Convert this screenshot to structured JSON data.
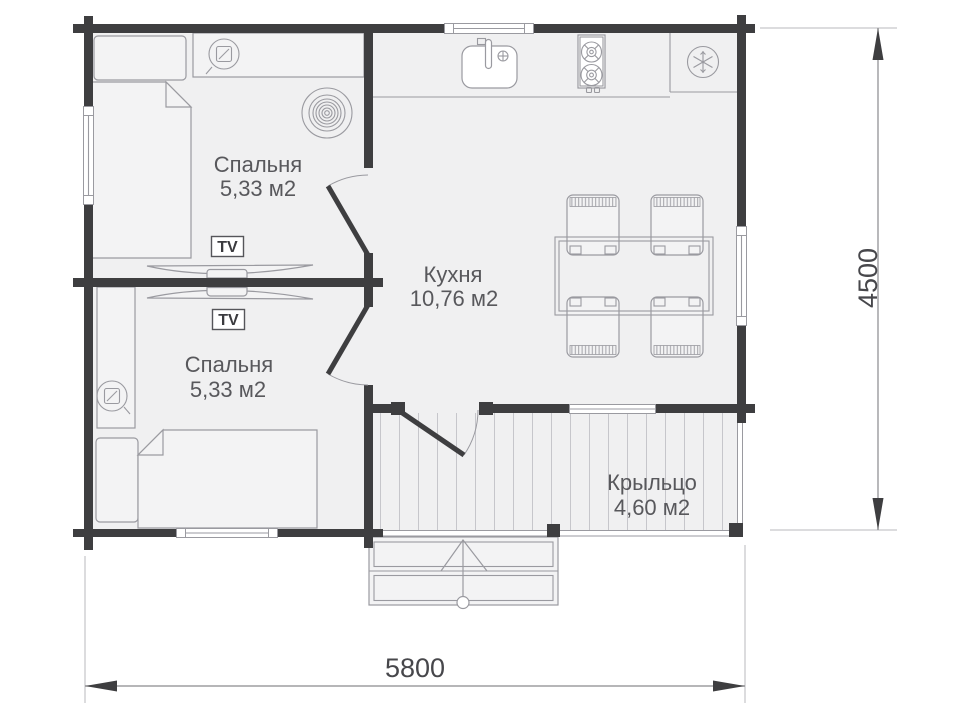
{
  "page": {
    "type": "floor-plan"
  },
  "colors": {
    "background": "#ffffff",
    "wall": "#3e3e40",
    "floor": "#f0f0f1",
    "furnfill": "#f3f3f4",
    "line": "#9a9aa0",
    "deck": "#c6c6cb",
    "text": "#58585c",
    "dimtext": "#47474b",
    "dimline": "#8a8a8e",
    "arrow": "#3e3e40"
  },
  "rooms": {
    "bedroom_top": {
      "name": "Спальня",
      "area": "5,33 м2"
    },
    "bedroom_bottom": {
      "name": "Спальня",
      "area": "5,33 м2"
    },
    "kitchen": {
      "name": "Кухня",
      "area": "10,76 м2"
    },
    "porch": {
      "name": "Крыльцо",
      "area": "4,60 м2"
    }
  },
  "labels": {
    "tv_top": "TV",
    "tv_bottom": "TV"
  },
  "dimensions": {
    "width": "5800",
    "height": "4500"
  },
  "icons": [
    "bed-icon",
    "pillow-icon",
    "wardrobe-icon",
    "shelf-icon",
    "wall-lamp-icon",
    "heating-coil-icon",
    "tv-icon",
    "tv-stand-icon",
    "sink-icon",
    "faucet-icon",
    "stove-icon",
    "burner-icon",
    "snowflake-icon",
    "dining-table-icon",
    "chair-icon",
    "door-swing-icon",
    "window-icon",
    "stairs-icon",
    "entry-arrow-icon",
    "dimension-arrow-icon"
  ]
}
